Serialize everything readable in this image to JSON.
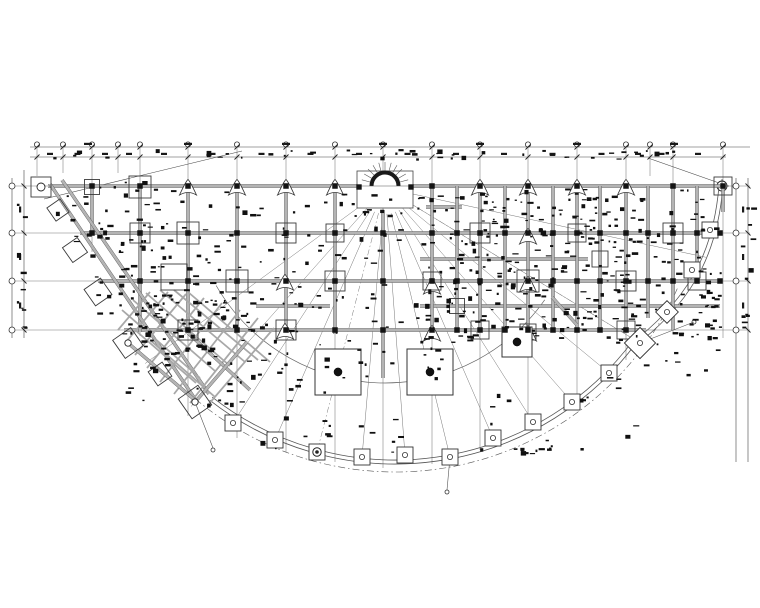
{
  "meta": {
    "drawing_type": "structural-beam-layout-plan",
    "shape": "fan-shaped half-round floor plan",
    "colors": {
      "ink": "#1a1a1a",
      "grid": "#787878",
      "beam_fill": "#b4b4b4",
      "beam_edge": "#5c5c5c",
      "thin": "#555555",
      "bg": "#ffffff"
    }
  },
  "fan_center": {
    "x": 385,
    "y": 188
  },
  "grid": {
    "verticals": [
      [
        37,
        176
      ],
      [
        63,
        173
      ],
      [
        92,
        252
      ],
      [
        118,
        173
      ],
      [
        140,
        336
      ],
      [
        188,
        416
      ],
      [
        237,
        438
      ],
      [
        286,
        452
      ],
      [
        335,
        462
      ],
      [
        383,
        468
      ],
      [
        432,
        464
      ],
      [
        480,
        450
      ],
      [
        528,
        430
      ],
      [
        577,
        402
      ],
      [
        626,
        360
      ],
      [
        650,
        176
      ],
      [
        673,
        334
      ],
      [
        723,
        338
      ]
    ],
    "vertical_top": 147,
    "horizontal_rows": [
      186,
      233,
      281,
      330
    ],
    "horizontal_x1": 12,
    "horizontal_x2": 750
  },
  "dimensions": {
    "top_lines": [
      {
        "y": 147,
        "x1": 30,
        "x2": 750
      },
      {
        "y": 157,
        "x1": 30,
        "x2": 726
      }
    ],
    "left_lines": [
      {
        "x": 12,
        "y1": 178,
        "y2": 338
      },
      {
        "x": 24,
        "y1": 170,
        "y2": 338
      }
    ],
    "right_lines": [
      {
        "x": 736,
        "y1": 178,
        "y2": 462
      },
      {
        "x": 748,
        "y1": 178,
        "y2": 462
      }
    ],
    "diagonals": [
      [
        44,
        199,
        242,
        151
      ],
      [
        648,
        158,
        722,
        184
      ]
    ],
    "wide_span_label_y": 144,
    "pair_label_y": 154,
    "row_label_x_left": 20,
    "row_label_x_right": 743
  },
  "bubbles": {
    "top_r": 2.6,
    "row_r": 3.0,
    "big_crosshair": {
      "x": 722,
      "y": 186,
      "r": 5
    }
  },
  "beams": {
    "horizontal": [
      [
        48,
        186,
        720
      ],
      [
        80,
        233,
        720
      ],
      [
        98,
        281,
        720
      ],
      [
        124,
        330,
        646
      ],
      [
        426,
        207,
        462
      ],
      [
        420,
        259,
        588
      ],
      [
        256,
        306,
        330
      ],
      [
        420,
        306,
        720
      ]
    ],
    "vertical": [
      [
        92,
        186,
        235
      ],
      [
        140,
        186,
        332
      ],
      [
        188,
        186,
        332
      ],
      [
        237,
        186,
        332
      ],
      [
        286,
        186,
        332
      ],
      [
        335,
        186,
        334
      ],
      [
        383,
        210,
        378
      ],
      [
        432,
        186,
        334
      ],
      [
        457,
        186,
        330
      ],
      [
        480,
        186,
        332
      ],
      [
        505,
        186,
        330
      ],
      [
        528,
        186,
        332
      ],
      [
        553,
        186,
        330
      ],
      [
        577,
        186,
        332
      ],
      [
        600,
        186,
        330
      ],
      [
        626,
        186,
        332
      ],
      [
        648,
        186,
        318
      ],
      [
        673,
        186,
        330
      ],
      [
        697,
        186,
        262
      ],
      [
        723,
        186,
        212
      ]
    ],
    "diagonal": [
      [
        50,
        184,
        197,
        402
      ],
      [
        62,
        180,
        209,
        394
      ],
      [
        552,
        297,
        577,
        325
      ]
    ]
  },
  "lattice": {
    "segments": [
      [
        122,
        310,
        200,
        378
      ],
      [
        133,
        300,
        215,
        371
      ],
      [
        146,
        293,
        230,
        366
      ],
      [
        160,
        290,
        245,
        362
      ],
      [
        174,
        290,
        258,
        360
      ],
      [
        188,
        292,
        270,
        362
      ],
      [
        150,
        292,
        118,
        330
      ],
      [
        168,
        292,
        126,
        342
      ],
      [
        186,
        294,
        135,
        355
      ],
      [
        204,
        298,
        147,
        368
      ],
      [
        222,
        303,
        160,
        382
      ],
      [
        240,
        310,
        174,
        394
      ],
      [
        258,
        318,
        190,
        403
      ],
      [
        274,
        328,
        208,
        405
      ],
      [
        150,
        340,
        215,
        397
      ],
      [
        135,
        330,
        196,
        383
      ]
    ],
    "mains": [
      [
        128,
        343,
        196,
        401
      ],
      [
        188,
        333,
        250,
        390
      ],
      [
        247,
        342,
        196,
        401
      ]
    ]
  },
  "arcs": {
    "inner": {
      "cx": 385,
      "cy": 188,
      "r": 195,
      "a1": 35,
      "a2": 150
    },
    "colonnade": [
      {
        "cx": 395,
        "cy": 163,
        "r": 297,
        "a1": 36,
        "a2": 128
      },
      {
        "cx": 395,
        "cy": 163,
        "r": 301,
        "a1": 36,
        "a2": 128
      }
    ],
    "dashdot": {
      "cx": 395,
      "cy": 163,
      "r": 309,
      "a1": 24,
      "a2": 132
    },
    "outer_paths": [
      "M723,186 C718,245 699,295 641,341",
      "M719,186 C714,243 696,291 638,338"
    ]
  },
  "radials": {
    "start_r": 26,
    "targets": [
      [
        233,
        423
      ],
      [
        275,
        440
      ],
      [
        362,
        457
      ],
      [
        405,
        455
      ],
      [
        450,
        457
      ],
      [
        493,
        438
      ],
      [
        533,
        422
      ],
      [
        572,
        402
      ],
      [
        609,
        373
      ],
      [
        640,
        343
      ],
      [
        700,
        256
      ],
      [
        195,
        402
      ],
      [
        150,
        360
      ]
    ],
    "dash_targets": [
      [
        317,
        452
      ],
      [
        640,
        343
      ]
    ]
  },
  "stair_fan": {
    "rect": {
      "x": 357,
      "y": 171,
      "w": 56,
      "h": 37
    },
    "arc_r": 13.5,
    "spoke_r1": 15.5,
    "spoke_r2": 24,
    "spoke_angles": [
      195,
      210,
      225,
      240,
      255,
      270,
      285,
      300,
      315,
      330,
      345
    ],
    "corner_squares": [
      [
        359,
        187
      ],
      [
        411,
        187
      ]
    ]
  },
  "columns": {
    "dot_size": 5.5,
    "rows": [
      {
        "y": 186,
        "xs": [
          92,
          140,
          188,
          237,
          286,
          335,
          432,
          480,
          528,
          577,
          626,
          673,
          723
        ]
      },
      {
        "y": 233,
        "xs": [
          92,
          140,
          188,
          237,
          286,
          335,
          383,
          432,
          457,
          480,
          505,
          528,
          553,
          577,
          600,
          626,
          648,
          673,
          697,
          720
        ]
      },
      {
        "y": 281,
        "xs": [
          140,
          188,
          237,
          286,
          335,
          383,
          432,
          457,
          480,
          528,
          553,
          577,
          600,
          626,
          648,
          673,
          697,
          720
        ]
      },
      {
        "y": 330,
        "xs": [
          188,
          237,
          286,
          335,
          383,
          432,
          457,
          480,
          505,
          528,
          553,
          577,
          600,
          626
        ]
      }
    ],
    "extra_dots": [
      [
        338,
        372
      ],
      [
        430,
        372
      ],
      [
        517,
        342
      ]
    ],
    "outline_squares": [
      [
        41,
        187,
        20
      ],
      [
        92,
        187,
        15
      ],
      [
        140,
        187,
        22
      ],
      [
        723,
        186,
        18
      ],
      [
        140,
        233,
        20
      ],
      [
        188,
        233,
        22
      ],
      [
        286,
        233,
        20
      ],
      [
        335,
        233,
        18
      ],
      [
        480,
        233,
        20
      ],
      [
        577,
        233,
        18
      ],
      [
        673,
        233,
        20
      ],
      [
        174,
        277,
        26
      ],
      [
        237,
        281,
        22
      ],
      [
        335,
        281,
        20
      ],
      [
        432,
        281,
        18
      ],
      [
        528,
        281,
        22
      ],
      [
        626,
        281,
        20
      ],
      [
        697,
        281,
        18
      ],
      [
        600,
        259,
        16
      ],
      [
        188,
        330,
        20
      ],
      [
        286,
        330,
        20
      ],
      [
        480,
        330,
        18
      ],
      [
        528,
        332,
        16
      ],
      [
        626,
        330,
        18
      ],
      [
        457,
        306,
        15
      ]
    ],
    "triangles": [
      [
        188,
        186
      ],
      [
        237,
        186
      ],
      [
        286,
        186
      ],
      [
        335,
        186
      ],
      [
        480,
        186
      ],
      [
        528,
        186
      ],
      [
        577,
        186
      ],
      [
        626,
        186
      ],
      [
        528,
        235
      ],
      [
        285,
        281
      ],
      [
        432,
        285
      ],
      [
        528,
        283
      ],
      [
        285,
        330
      ],
      [
        432,
        332
      ],
      [
        528,
        332
      ]
    ],
    "big_squares": [
      [
        338,
        372,
        46
      ],
      [
        430,
        372,
        46
      ],
      [
        517,
        342,
        30
      ]
    ],
    "colonnade_squares": [
      {
        "x": 233,
        "y": 423
      },
      {
        "x": 275,
        "y": 440
      },
      {
        "x": 317,
        "y": 452,
        "ring": 1
      },
      {
        "x": 362,
        "y": 457
      },
      {
        "x": 405,
        "y": 455
      },
      {
        "x": 450,
        "y": 457
      },
      {
        "x": 493,
        "y": 438
      },
      {
        "x": 533,
        "y": 422
      },
      {
        "x": 572,
        "y": 402
      },
      {
        "x": 609,
        "y": 373
      },
      {
        "x": 640,
        "y": 343,
        "rot": 45,
        "s": 22
      },
      {
        "x": 667,
        "y": 312,
        "rot": 45,
        "s": 16
      },
      {
        "x": 692,
        "y": 270
      },
      {
        "x": 710,
        "y": 230
      }
    ],
    "band_squares": [
      {
        "x": 58,
        "y": 210,
        "s": 16
      },
      {
        "x": 75,
        "y": 250,
        "s": 18
      },
      {
        "x": 98,
        "y": 292,
        "s": 20
      },
      {
        "x": 128,
        "y": 343,
        "s": 22,
        "ring": 1
      },
      {
        "x": 160,
        "y": 374,
        "s": 17
      },
      {
        "x": 195,
        "y": 402,
        "s": 24,
        "ring": 1
      }
    ],
    "band_square_rot": 55
  },
  "leaders": {
    "lines": [
      [
        450,
        457,
        447,
        490
      ],
      [
        640,
        343,
        694,
        322
      ],
      [
        195,
        402,
        213,
        448
      ]
    ],
    "end_circles": [
      [
        447,
        492
      ],
      [
        694,
        322
      ],
      [
        213,
        450
      ]
    ]
  },
  "annotation_clusters": [
    {
      "x": 48,
      "y": 149,
      "w": 660,
      "h": 10,
      "n": 46,
      "seed": 11
    },
    {
      "x": 558,
      "y": 188,
      "w": 162,
      "h": 150,
      "n": 170,
      "seed": 23
    },
    {
      "x": 424,
      "y": 188,
      "w": 130,
      "h": 152,
      "n": 150,
      "seed": 37
    },
    {
      "x": 262,
      "y": 188,
      "w": 160,
      "h": 145,
      "n": 60,
      "seed": 41
    },
    {
      "x": 145,
      "y": 188,
      "w": 115,
      "h": 145,
      "n": 55,
      "seed": 53
    },
    {
      "x": 55,
      "y": 180,
      "w": 90,
      "h": 70,
      "n": 30,
      "seed": 61
    },
    {
      "x": 90,
      "y": 235,
      "w": 80,
      "h": 80,
      "n": 35,
      "seed": 71
    },
    {
      "x": 118,
      "y": 300,
      "w": 92,
      "h": 60,
      "n": 30,
      "seed": 83
    },
    {
      "x": 125,
      "y": 293,
      "w": 205,
      "h": 112,
      "n": 90,
      "seed": 97
    },
    {
      "x": 330,
      "y": 340,
      "w": 130,
      "h": 40,
      "n": 18,
      "seed": 101
    },
    {
      "x": 598,
      "y": 330,
      "w": 120,
      "h": 60,
      "n": 16,
      "seed": 113
    },
    {
      "x": 250,
      "y": 415,
      "w": 160,
      "h": 40,
      "n": 14,
      "seed": 131
    },
    {
      "x": 470,
      "y": 390,
      "w": 170,
      "h": 60,
      "n": 14,
      "seed": 139
    },
    {
      "x": 516,
      "y": 446,
      "w": 38,
      "h": 8,
      "n": 9,
      "seed": 149
    },
    {
      "x": 740,
      "y": 200,
      "w": 12,
      "h": 130,
      "n": 12,
      "seed": 151
    },
    {
      "x": 16,
      "y": 190,
      "w": 10,
      "h": 140,
      "n": 10,
      "seed": 157
    }
  ]
}
